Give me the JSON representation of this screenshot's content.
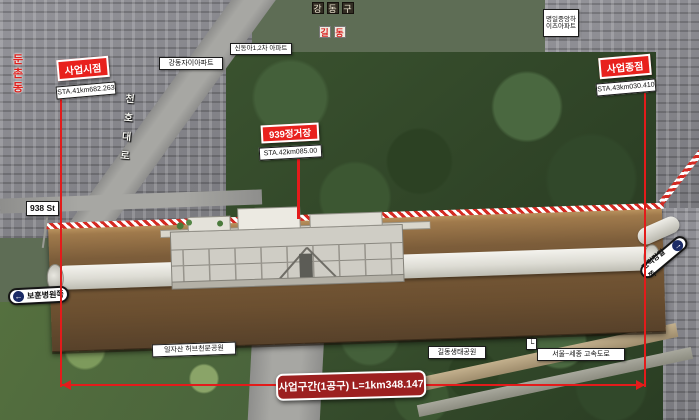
{
  "annotations": {
    "start_point": {
      "label": "사업시점",
      "station": "STA.41km682.263"
    },
    "end_point": {
      "label": "사업종점",
      "station": "STA.43km030.410"
    },
    "station_939": {
      "label": "939정거장",
      "station": "STA.42km085.00"
    },
    "banner": {
      "text": "사업구간(1공구)  L=1km348.147"
    }
  },
  "place_labels": {
    "dunchon_dong": "둔촌동",
    "cheonho_daero": "천호대로",
    "gangdong_gu": "강동구",
    "gil_dong": "길동",
    "gangdong_xi_apt": "강동자이아파트",
    "sindonga_apt": "신동아1,2차 아파트",
    "myeongil_apt": "명일중앙하이츠아파트",
    "station_938": "938 St",
    "bohun_hospital_dir": "보훈병원쪽",
    "godeok_gangil_dir": "고덕강일쪽",
    "iljasan_park": "일자산 허브천문공원",
    "gildong_eco_park": "길동생태공원",
    "expressway": "서울~세종 고속도로"
  },
  "icons": {
    "left_arrow": "←",
    "right_arrow": "→",
    "corner_connector": "└"
  },
  "colors": {
    "marker_red": "#e8211d",
    "dimension_red": "#e31b1b",
    "banner_red": "#9c2020",
    "tunnel_white": "#f4f3ee",
    "soil_brown": "#6b4f30"
  }
}
